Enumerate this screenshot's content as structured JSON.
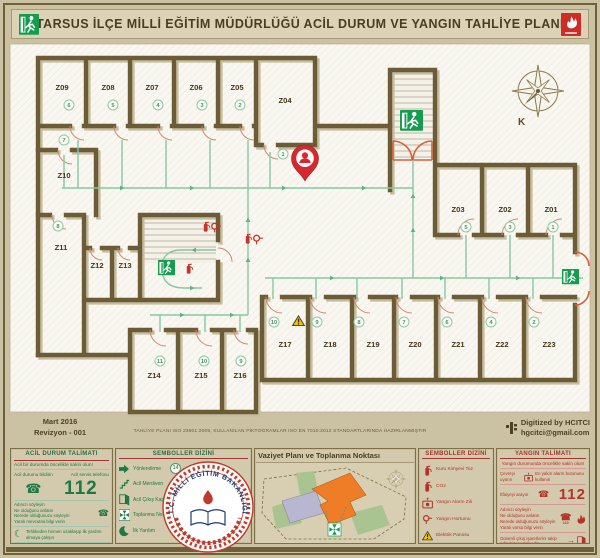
{
  "header": {
    "title": "TARSUS İLÇE MİLLİ EĞİTİM MÜDÜRLÜĞÜ ACİL DURUM VE YANGIN TAHLİYE PLANI"
  },
  "plan": {
    "compass_label": "K",
    "standard_note": "TAHLİYE PLANI ISO 23601:2009, KULLANILAN PİKTOGRAMLAR ISO EN 7010:2012 STANDARTLARINDA HAZIRLANMIŞTIR",
    "rooms": [
      {
        "label": "Z09",
        "order": "6"
      },
      {
        "label": "Z08",
        "order": "5"
      },
      {
        "label": "Z07",
        "order": "4"
      },
      {
        "label": "Z06",
        "order": "3"
      },
      {
        "label": "Z05",
        "order": "2"
      },
      {
        "label": "Z04",
        "order": "1"
      },
      {
        "label": "Z10",
        "order": "7"
      },
      {
        "label": "Z11",
        "order": "8"
      },
      {
        "label": "Z12",
        "order": ""
      },
      {
        "label": "Z13",
        "order": ""
      },
      {
        "label": "Z14",
        "order": "11"
      },
      {
        "label": "Z15",
        "order": "10"
      },
      {
        "label": "Z16",
        "order": "9"
      },
      {
        "label": "Z17",
        "order": "10"
      },
      {
        "label": "Z18",
        "order": "9"
      },
      {
        "label": "Z19",
        "order": "8"
      },
      {
        "label": "Z20",
        "order": "7"
      },
      {
        "label": "Z21",
        "order": "6"
      },
      {
        "label": "Z22",
        "order": "4"
      },
      {
        "label": "Z23",
        "order": "2"
      },
      {
        "label": "Z03",
        "order": "5"
      },
      {
        "label": "Z02",
        "order": "3"
      },
      {
        "label": "Z01",
        "order": "1"
      }
    ]
  },
  "meta": {
    "date": "Mart 2016",
    "revision": "Revizyon - 001",
    "digitized_by": "Digitized by HCITCI",
    "digitized_email": "hgcitci@gmail.com"
  },
  "panels": {
    "emergency": {
      "title": "ACİL DURUM TALİMATI",
      "intro": "Acil bir durumda öncelikle sakin olun!",
      "report_label": "Acil durumu bildirin",
      "phone_label": "Acil servis telefonu",
      "phone_number": "112",
      "steps": [
        "Adınızı söyleyin",
        "Ne olduğunu anlatın",
        "Nerede olduğunuzu söyleyin",
        "Yaralı mevcutsa bilgi verin"
      ],
      "aid_note": "Tehlikeden hemen uzaklaşıp ilk yardım almaya çalışın",
      "exit_note": "Düzenli yer işaretlerini takip edip çıkışı bulun"
    },
    "symbols_green": {
      "title": "SEMBOLLER DİZİNİ",
      "order_badge": "14",
      "order_label": "Tahliye Sırası",
      "items": [
        "Yönlendirme",
        "Acil Merdiven",
        "Acil Çıkış Kapısı",
        "Toplanma Noktası",
        "İlk Yardım",
        "Tahliye Yolu"
      ]
    },
    "site": {
      "title": "Vaziyet Planı ve Toplanma Noktası"
    },
    "symbols_red": {
      "title": "SEMBOLLER DİZİNİ",
      "items": [
        "Kuru Kimyevi Toz",
        "CO2",
        "Yangın Alarm Zili",
        "Yangın Hortumu",
        "Elektrik Panosu"
      ]
    },
    "fire": {
      "title": "YANGIN TALİMATI",
      "intro": "Yangın durumunda öncelikle sakin olun!",
      "warn_label": "Çevreyi uyarın",
      "alarm_note": "En yakın alarm butonunu kullanın",
      "call_label": "İtfaiyeyi arayın",
      "phone_number": "112",
      "aux_number": "110",
      "steps": [
        "Adınızı söyleyin",
        "Ne olduğunu anlatın",
        "Nerede olduğunuzu söyleyin",
        "Yaralı varsa bilgi verin"
      ],
      "exit_note": "Güvenli çıkış işaretlerini takip edip binayı terk edin",
      "assembly_note": "Toplanma noktasına gidin ve orada bilgi verin"
    },
    "logo": {
      "text": "T.C. MİLLİ EĞİTİM BAKANLIĞI"
    }
  }
}
